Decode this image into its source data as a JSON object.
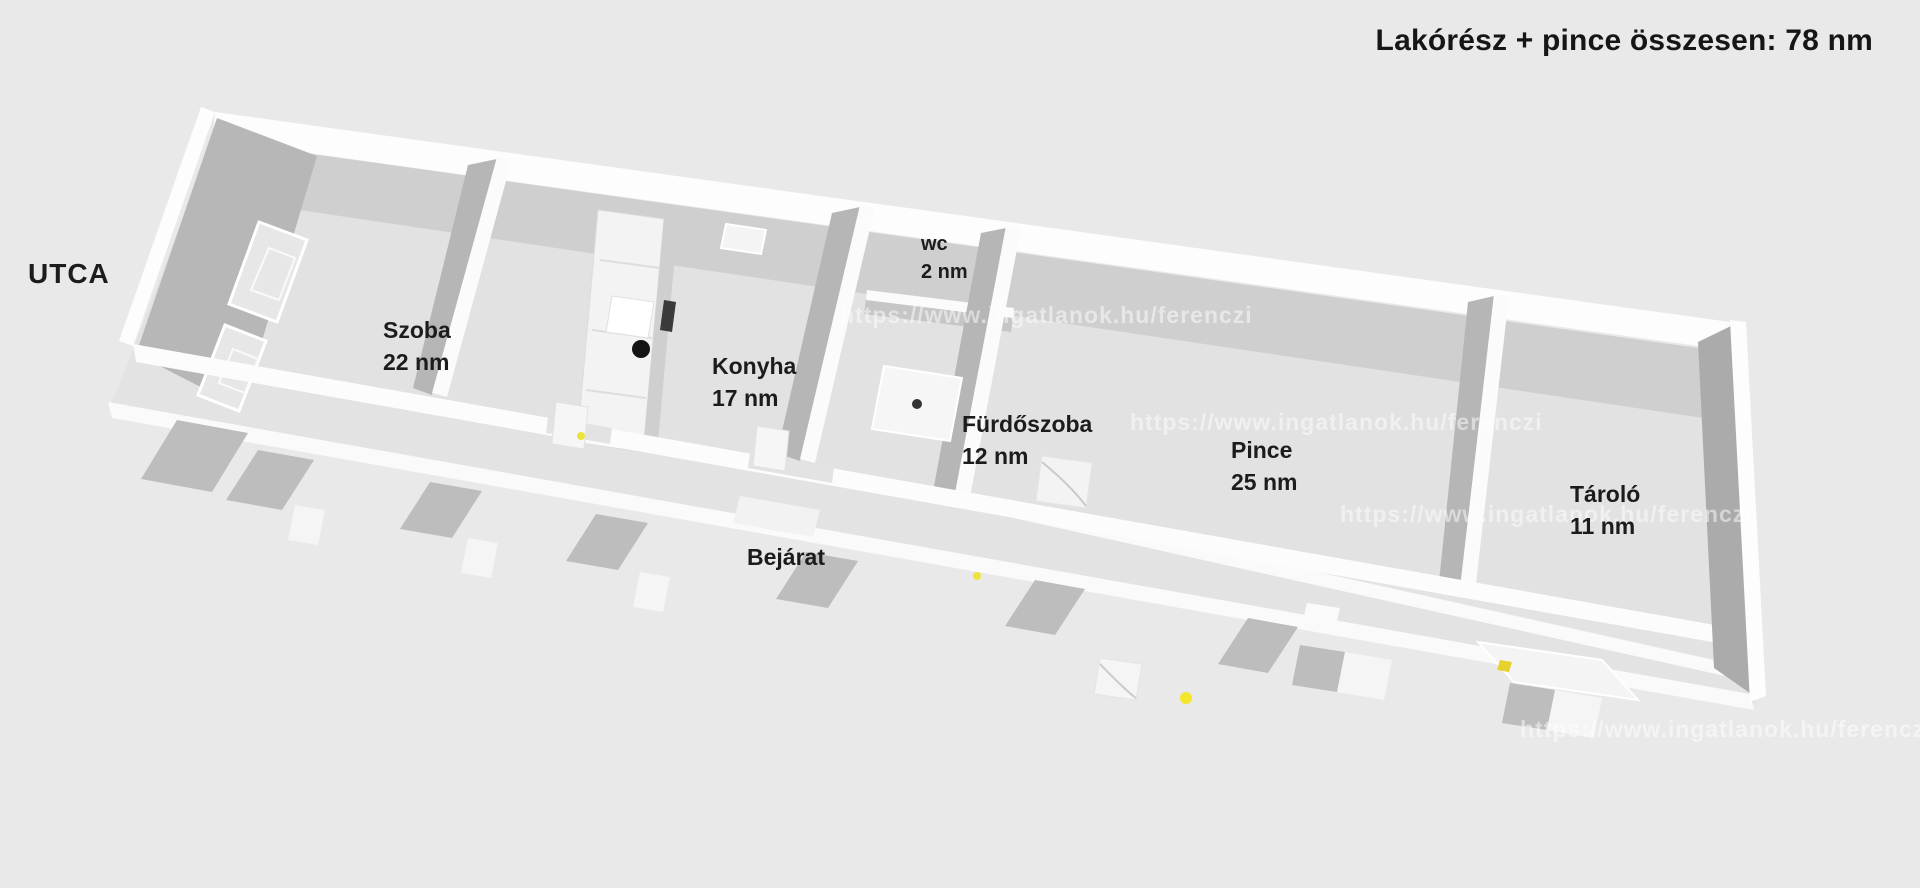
{
  "title": "Lakórész + pince összesen: 78 nm",
  "street_label": "UTCA",
  "entrance_label": "Bejárat",
  "rooms": [
    {
      "name": "Szoba",
      "area": "22 nm"
    },
    {
      "name": "Konyha",
      "area": "17 nm"
    },
    {
      "name": "wc",
      "area": "2 nm"
    },
    {
      "name": "Fürdőszoba",
      "area": "12 nm"
    },
    {
      "name": "Pince",
      "area": "25 nm"
    },
    {
      "name": "Tároló",
      "area": "11 nm"
    }
  ],
  "watermark": {
    "text": "https://www.ingatlanok.hu/ferenczi",
    "legible_fragments": [
      "https://",
      "/ferenc",
      "ingatlan",
      "llanok.h"
    ]
  },
  "colors": {
    "background": "#e9e9e9",
    "floor": "#e2e2e2",
    "wall_top": "#fdfdfd",
    "wall_face_shadow": "#b6b6b6",
    "accent_marker": "#efe23a",
    "text": "#1c1c1c"
  }
}
